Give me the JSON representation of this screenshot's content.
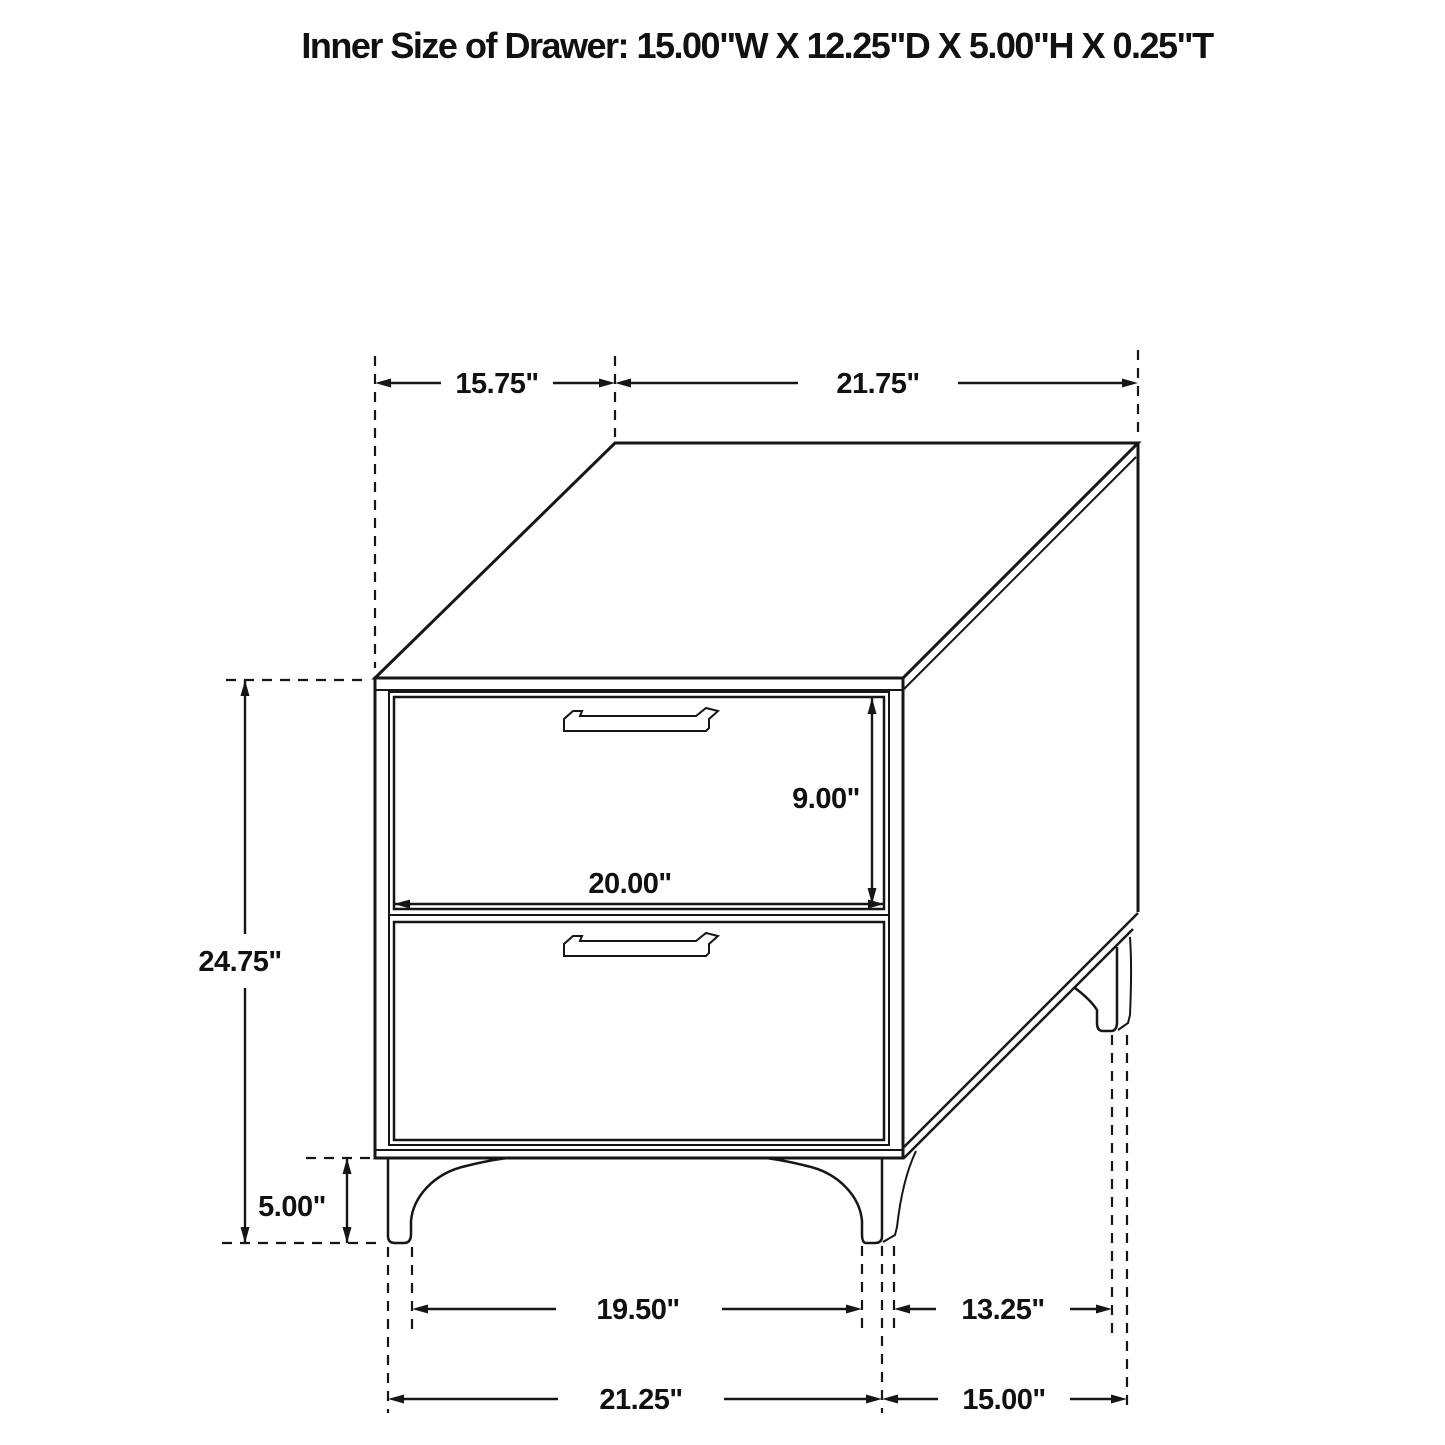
{
  "title": "Inner Size of Drawer: 15.00\"W X 12.25\"D X 5.00\"H X 0.25\"T",
  "dims": {
    "top_depth": "15.75\"",
    "top_width": "21.75\"",
    "drawer_opening_height": "9.00\"",
    "drawer_opening_width": "20.00\"",
    "body_height": "24.75\"",
    "leg_height": "5.00\"",
    "feet_span_inner_width": "19.50\"",
    "feet_span_inner_depth": "13.25\"",
    "feet_span_outer_width": "21.25\"",
    "feet_span_outer_depth": "15.00\""
  },
  "colors": {
    "line": "#161616",
    "background": "#ffffff"
  }
}
